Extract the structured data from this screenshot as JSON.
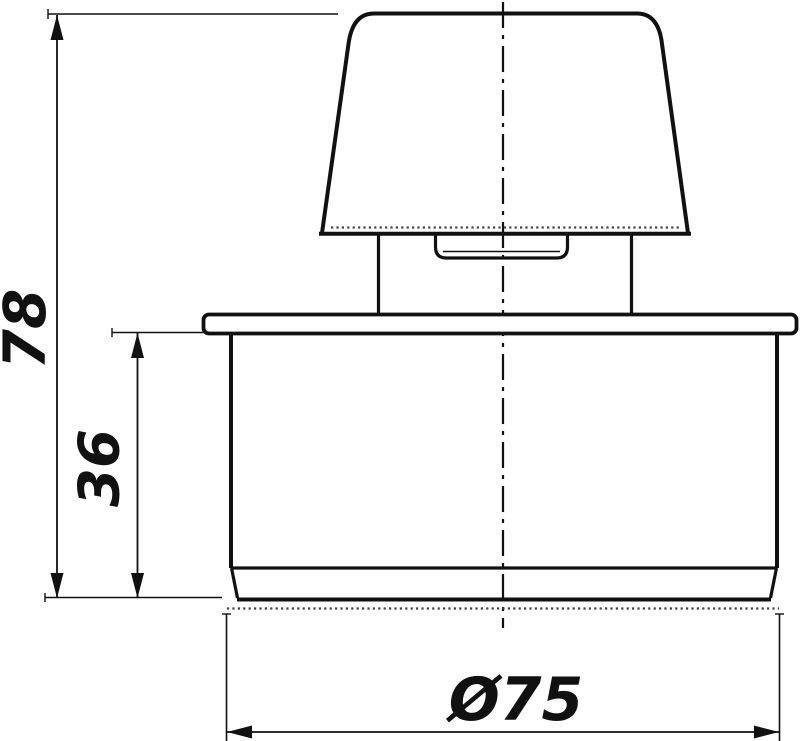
{
  "drawing": {
    "kind": "technical-dimension-drawing",
    "view": "front-elevation-of-capped-pipe-vent-fitting",
    "background_color": "#ffffff",
    "line_color": "#111111",
    "labels": {
      "overall_height": "78",
      "body_height": "36",
      "outer_diameter": "Ø75"
    }
  }
}
